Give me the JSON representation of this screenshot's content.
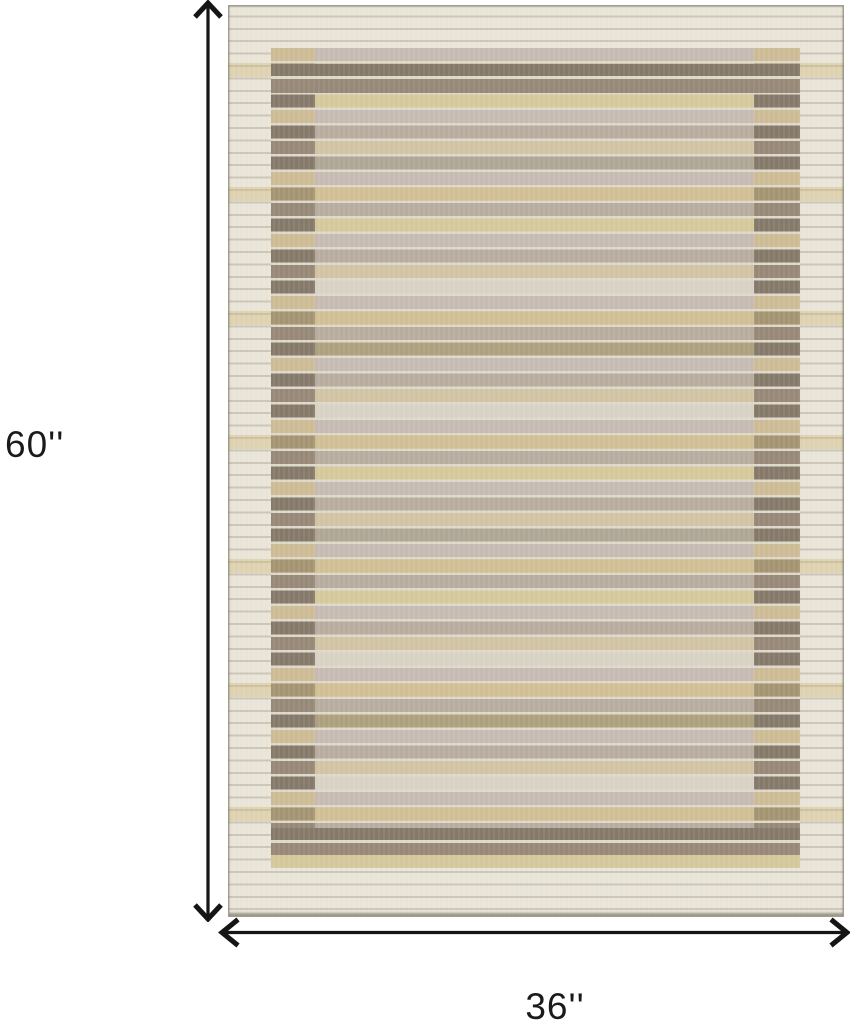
{
  "diagram": {
    "subject": "striped-area-rug",
    "height_label": "60''",
    "width_label": "36''",
    "height_inches": 60,
    "width_inches": 36
  },
  "colors": {
    "background": "#ffffff",
    "arrow": "#151515",
    "label_text": "#1a1a1a",
    "rug_border_cream": "#e8e4d7",
    "rug_cream_line": "#ddd8ca",
    "rug_field_mauve": "#c6bbb3",
    "rug_field_tan": "#d1c3a4",
    "rug_field_gray": "#b7ac9e",
    "rug_field_gold": "#d5c89b",
    "rug_field_light": "#d8d2c4",
    "rug_key_tan": "#ccbb95",
    "rug_dark_band": "#85796a",
    "rug_dark_band_2": "#978877"
  }
}
